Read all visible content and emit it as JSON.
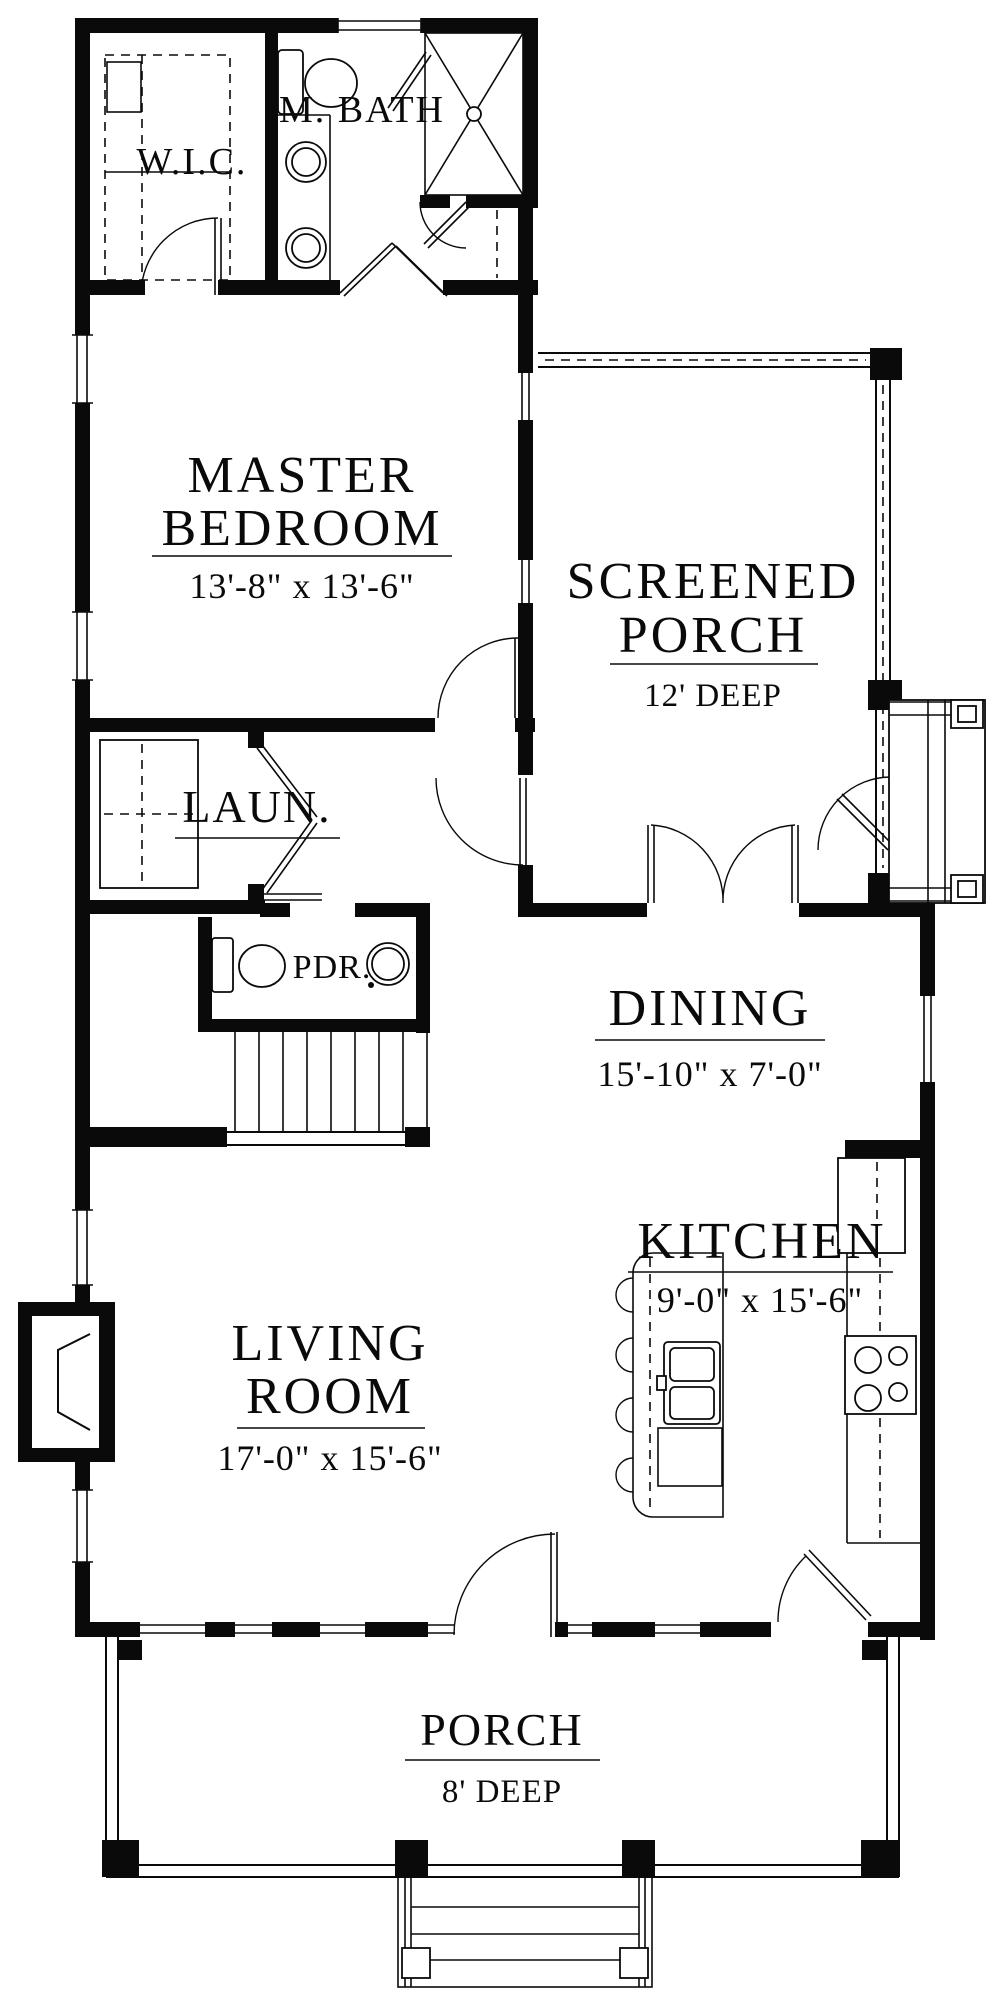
{
  "colors": {
    "wall": "#0a0a0a",
    "background": "#ffffff"
  },
  "rooms": {
    "wic": {
      "label": "W.I.C."
    },
    "mbath": {
      "label": "M. BATH"
    },
    "master": {
      "line1": "MASTER",
      "line2": "BEDROOM",
      "dims": "13'-8\" x 13'-6\""
    },
    "screened_porch": {
      "line1": "SCREENED",
      "line2": "PORCH",
      "dims": "12' DEEP"
    },
    "laundry": {
      "label": "LAUN."
    },
    "powder": {
      "label": "PDR."
    },
    "dining": {
      "label": "DINING",
      "dims": "15'-10\" x 7'-0\""
    },
    "kitchen": {
      "label": "KITCHEN",
      "dims": "9'-0\" x 15'-6\""
    },
    "living": {
      "line1": "LIVING",
      "line2": "ROOM",
      "dims": "17'-0\" x 15'-6\""
    },
    "porch": {
      "label": "PORCH",
      "dims": "8' DEEP"
    }
  }
}
